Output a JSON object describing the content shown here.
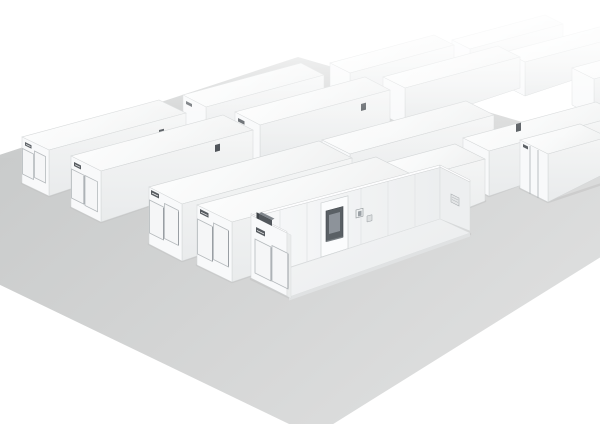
{
  "scene": {
    "description": "3D product rendering of white modular cold-storage rooms arranged in a grid on a light gray floor. The front-center module is shown open (no roof, no side wall) revealing interior panel walls, a white floor, an inner dark service hatch door, small electrical boxes and a cooling unit above the entrance. Closed modules in the front column have double service doors with small dark rating plates; some rear modules have small dark windows or vents. The scene fades to white toward the horizon.",
    "closed_module_count": 15,
    "open_module_count": 1,
    "modules_with_double_doors": 5,
    "modules_with_end_window": 3,
    "modules_with_vent": 3,
    "colors": {
      "background": "#ffffff",
      "ground-left": "#c8caca",
      "ground-right": "#e1e2e2",
      "roof-near": "#ffffff",
      "roof-far": "#f0f1f1",
      "side-top": "#f4f5f5",
      "side-bottom": "#e9ebec",
      "end-face": "#f8f9fa",
      "edge-line": "#d2d5d6",
      "door-line": "#b4b9bc",
      "hinge-line": "#8f959a",
      "label-plate": "#565b60",
      "window-dark": "#41464b",
      "window-inner": "#7d8389",
      "interior-wall": "#f5f6f7",
      "interior-wall-seam": "#e1e4e5",
      "interior-floor": "#f1f2f3",
      "inner-door": "#5a6065",
      "inner-door-panel": "#8d939a",
      "cooling-unit": "#52575c",
      "shadow": "#bfc0c0"
    }
  }
}
